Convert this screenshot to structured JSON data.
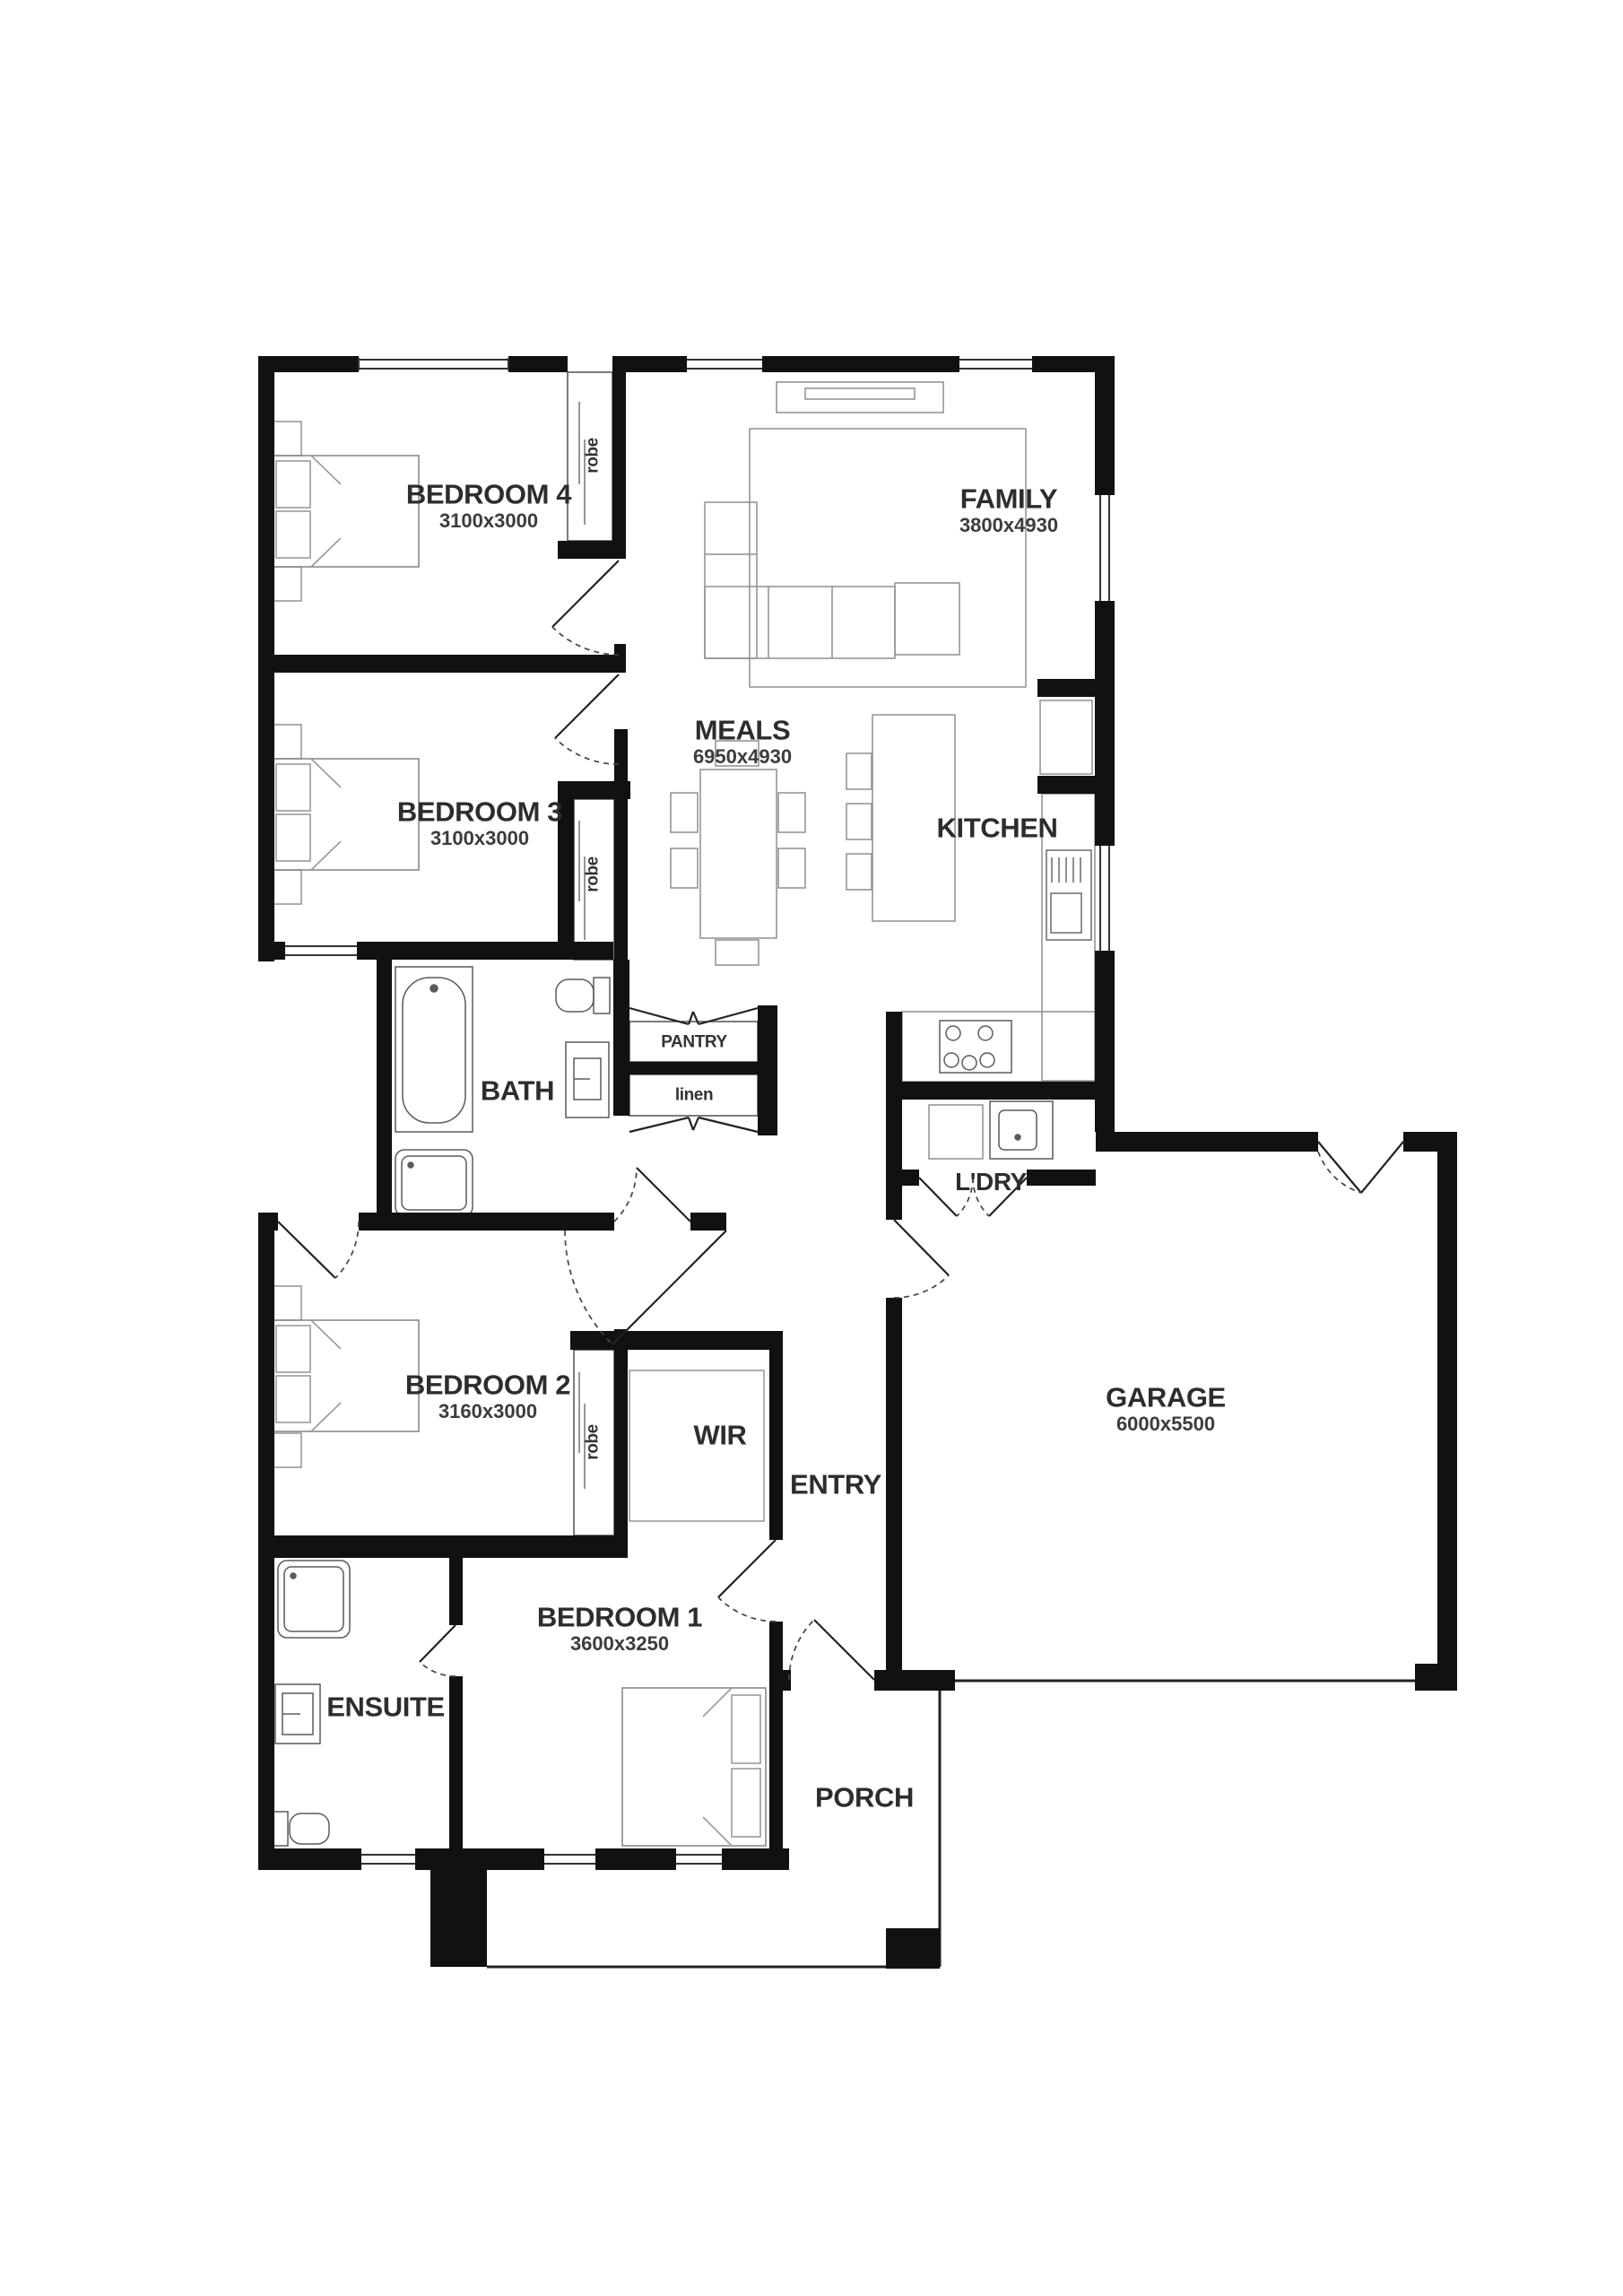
{
  "plan": {
    "rooms": [
      {
        "name": "BEDROOM 4",
        "dims": "3100x3000"
      },
      {
        "name": "FAMILY",
        "dims": "3800x4930"
      },
      {
        "name": "MEALS",
        "dims": "6950x4930"
      },
      {
        "name": "BEDROOM 3",
        "dims": "3100x3000"
      },
      {
        "name": "KITCHEN",
        "dims": ""
      },
      {
        "name": "BATH",
        "dims": ""
      },
      {
        "name": "BEDROOM 2",
        "dims": "3160x3000"
      },
      {
        "name": "WIR",
        "dims": ""
      },
      {
        "name": "ENTRY",
        "dims": ""
      },
      {
        "name": "GARAGE",
        "dims": "6000x5500"
      },
      {
        "name": "BEDROOM 1",
        "dims": "3600x3250"
      },
      {
        "name": "ENSUITE",
        "dims": ""
      },
      {
        "name": "PORCH",
        "dims": ""
      },
      {
        "name": "L'DRY",
        "dims": ""
      }
    ],
    "closets": {
      "robe": "robe",
      "pantry": "PANTRY",
      "linen": "linen"
    },
    "colors": {
      "wall": "#111111",
      "label": "#2d2d2d",
      "furniture": "#8f8f8f",
      "fixture": "#5a5a5a"
    }
  }
}
